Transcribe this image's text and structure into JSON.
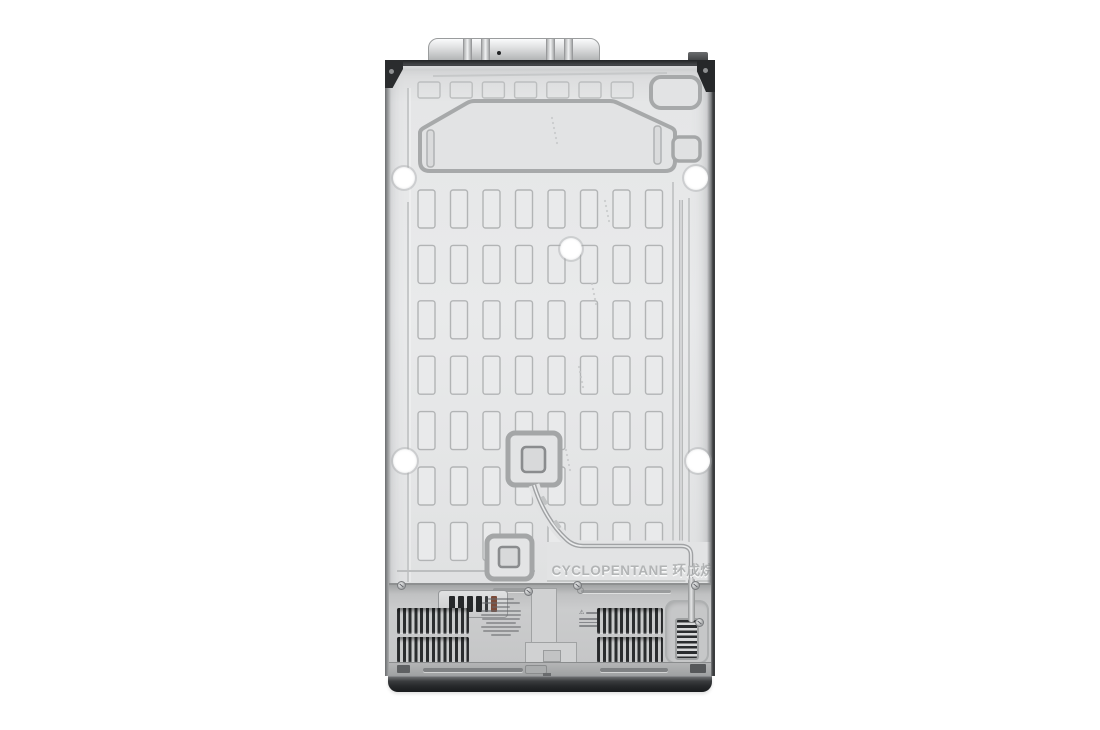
{
  "scene": {
    "description": "Rear view product photo of a side-by-side refrigerator back panel on a white background",
    "background_color": "#ffffff"
  },
  "labels": {
    "refrigerant_embossed_text": "CYCLOPENTANE 环戊烷"
  },
  "icons": {
    "warning_triangle": "⚠"
  },
  "colors": {
    "panel": "#e5e6e7",
    "emboss_line": "#a8aaab",
    "trim_dark": "#303234",
    "base_dark": "#1e2022",
    "vent_slat": "#2b2d2f",
    "compressor_cover": "#c8c9ca",
    "terminal_accent": "#7c4b39",
    "mounting_hole": "#ffffff"
  }
}
